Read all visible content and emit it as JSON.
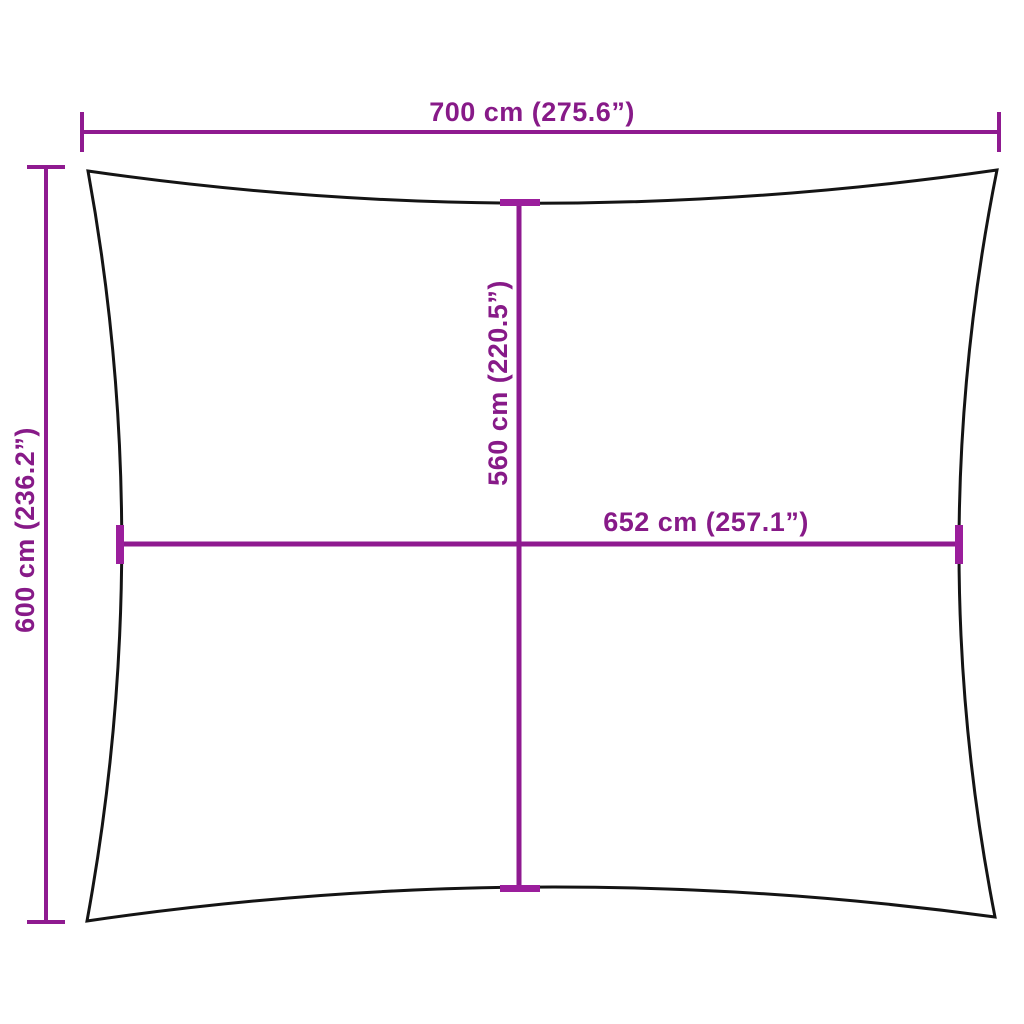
{
  "diagram": {
    "type": "shade-sail-dimension-diagram",
    "background_color": "#ffffff",
    "sail_outline_color": "#141414",
    "dimension_color": "#8F1A90",
    "label_color": "#871A88",
    "labels": {
      "top_width": "700 cm (275.6”)",
      "left_height": "600 cm (236.2”)",
      "inner_height": "560 cm (220.5”)",
      "inner_width": "652 cm (257.1”)"
    }
  }
}
